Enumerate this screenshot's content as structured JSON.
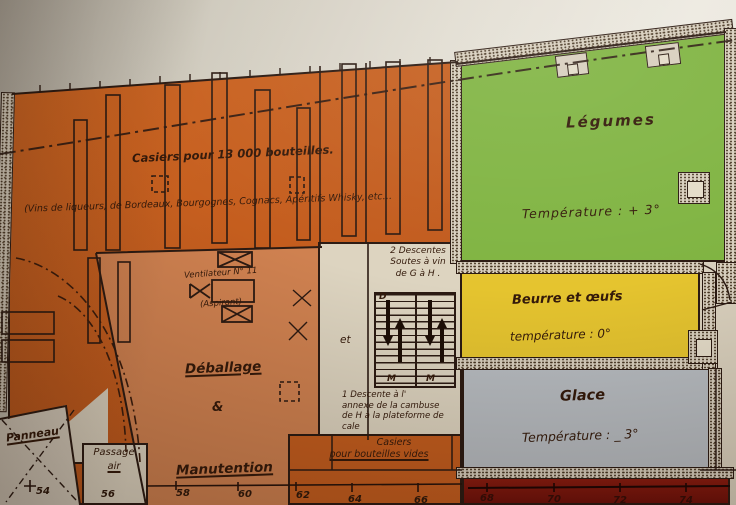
{
  "colors": {
    "wine_orange": "#c7601f",
    "handling_salmon": "#cf8150",
    "legumes_green": "#80b442",
    "beurre_yellow": "#e5c42f",
    "glace_gray": "#b7bcc1",
    "lower_deck_red": "#7d150f",
    "ink": "#2b1a12",
    "paper": "#ddd4c0"
  },
  "wine_cellar": {
    "title": "Casiers pour 13 000 bouteilles.",
    "wine_list": "(Vins de liqueurs, de Bordeaux, Bourgognes, Cognacs, Apéritifs Whisky, etc…",
    "ventilator_name": "Ventilateur N° 11",
    "ventilator_type": "(Aspirant)",
    "empty_bottles_line1": "Casiers",
    "empty_bottles_line2": "pour bouteilles vides"
  },
  "handling_area": {
    "line1": "Déballage",
    "amp": "&",
    "line2": "Manutention"
  },
  "stairs": {
    "two_descents": "2 Descentes\nSoutes à vin\nde G à H .",
    "et": "et",
    "one_descent": "1 Descente à l'\nannexe de la cambuse\nde H à la plateforme de\ncale",
    "letters": {
      "top": "D",
      "bottom_left": "M",
      "bottom_right": "M"
    }
  },
  "cold_rooms": {
    "legumes": {
      "name": "Légumes",
      "temperature": "Température :   + 3°"
    },
    "beurre_oeufs": {
      "name": "Beurre  et  œufs",
      "temperature": "température  :  0°"
    },
    "glace": {
      "name": "Glace",
      "temperature": "Température : _ 3°"
    }
  },
  "deck_labels": {
    "panneau": "Panneau",
    "passage": "Passage",
    "air": "air"
  },
  "frame_numbers": [
    "54",
    "56",
    "58",
    "60",
    "62",
    "64",
    "66",
    "68",
    "70",
    "72",
    "74"
  ]
}
